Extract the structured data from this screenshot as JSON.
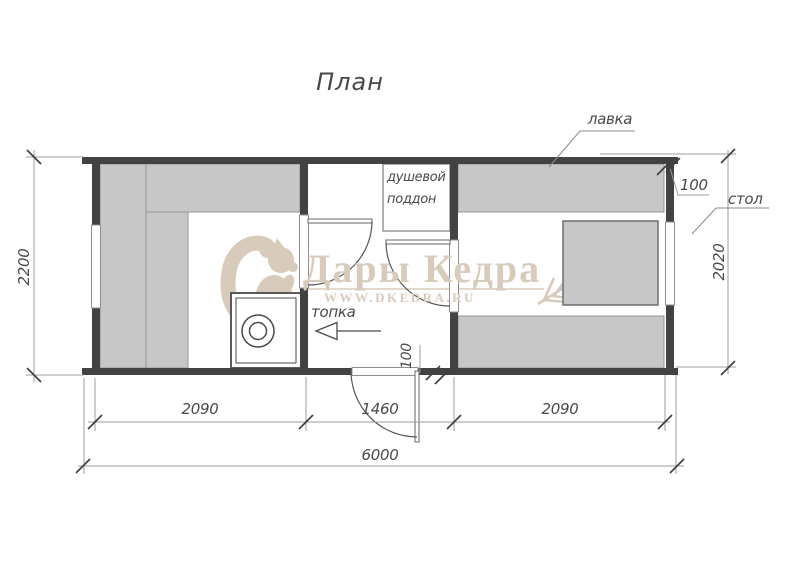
{
  "title": "План",
  "watermark": {
    "brand": "Дары Кедра",
    "site": "WWW.DKEDRA.RU"
  },
  "labels": {
    "bench": "лавка",
    "table": "стол",
    "stove": "топка",
    "shower_line1": "душевой",
    "shower_line2": "поддон"
  },
  "dimensions": {
    "total_width": "6000",
    "left_height": "2200",
    "right_height": "2020",
    "steam_room_width": "2090",
    "washroom_width": "1460",
    "rest_room_width": "2090",
    "wall_thickness_right": "100",
    "wall_thickness_door": "100"
  },
  "colors": {
    "wall": "#424242",
    "bench_fill": "#c7c7c7",
    "line": "#4a4a4a",
    "dim_line": "#9c9c9c",
    "watermark": "#d8cbbc"
  }
}
